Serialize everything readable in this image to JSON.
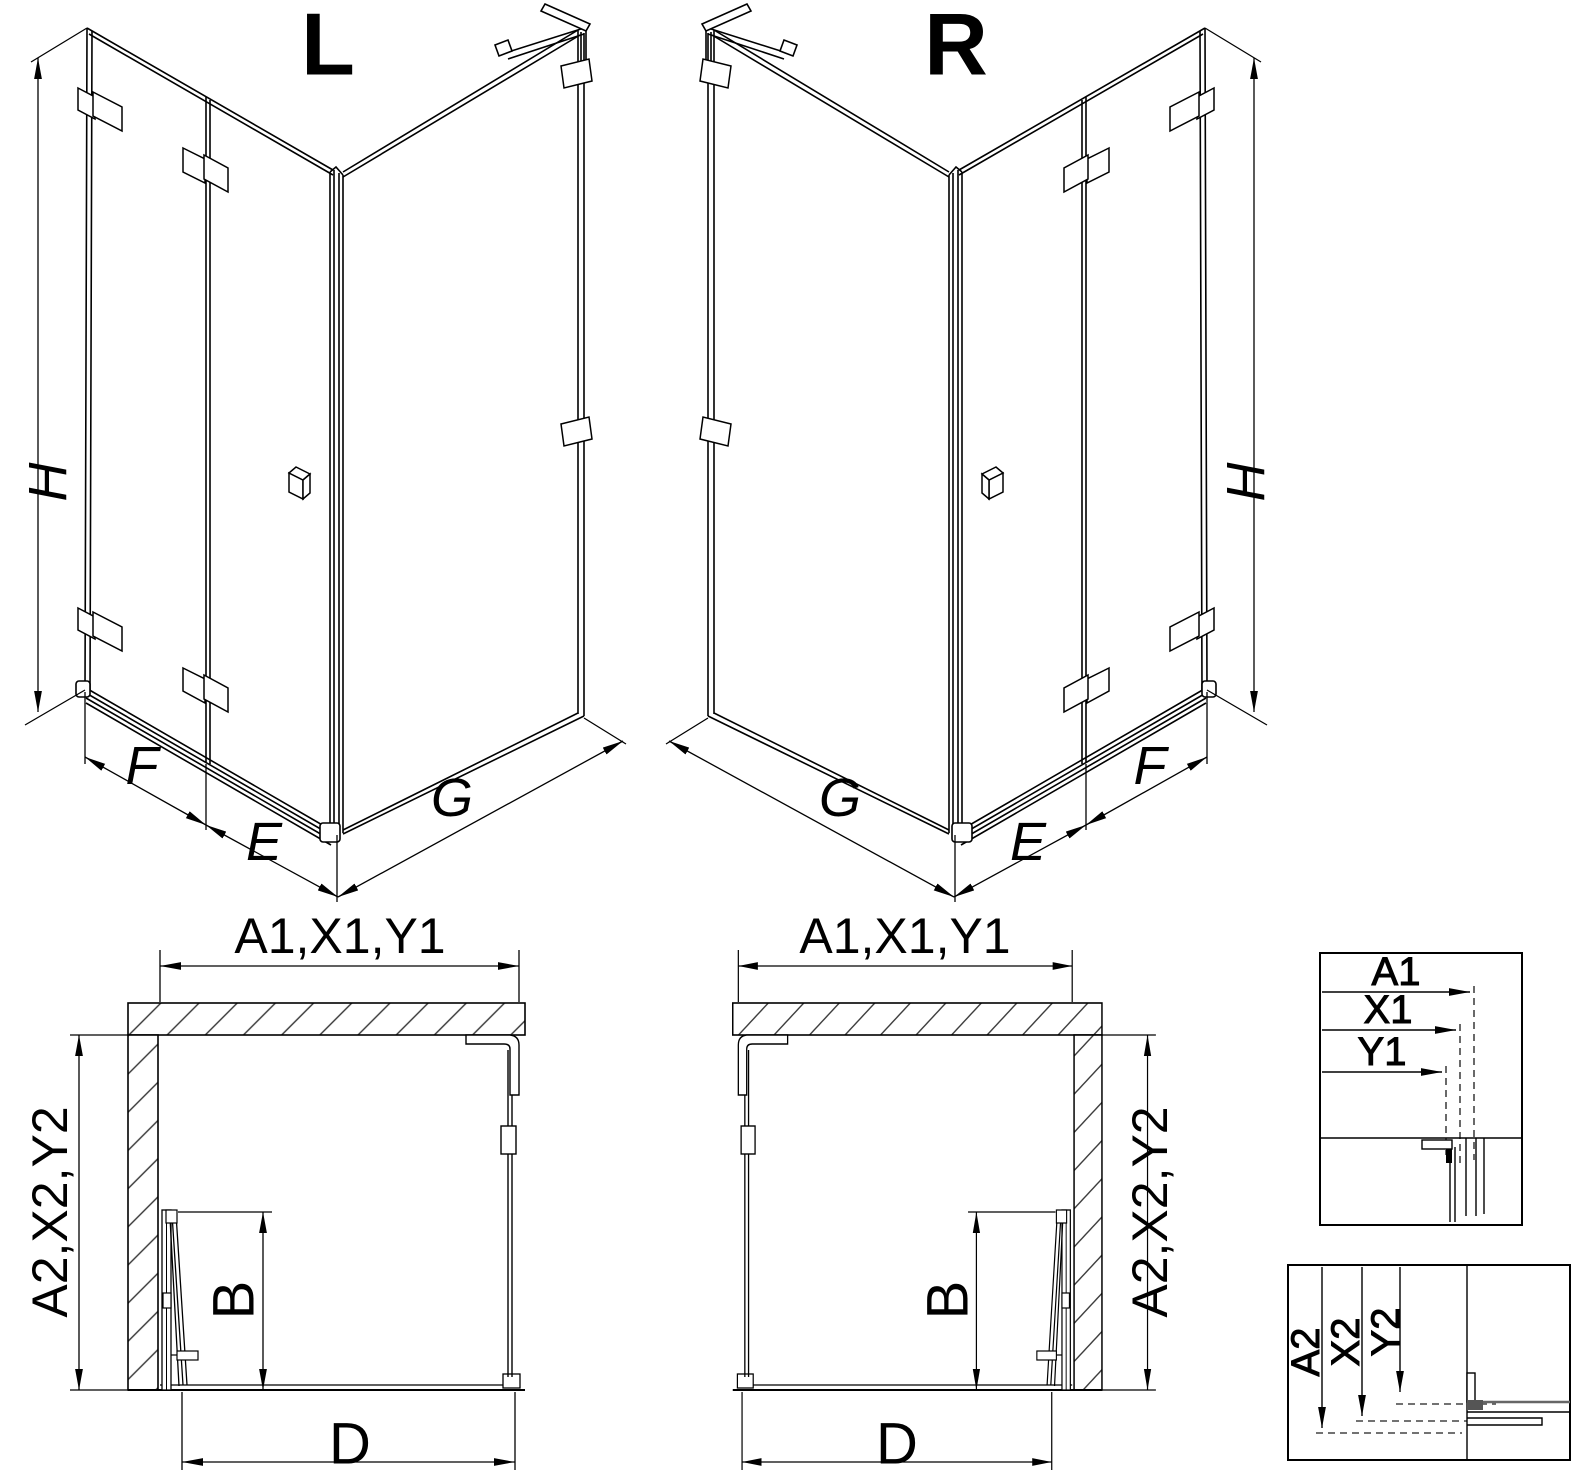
{
  "views": {
    "iso_left": {
      "title": "L",
      "height_label": "H",
      "width_labels": [
        "F",
        "E",
        "G"
      ]
    },
    "iso_right": {
      "title": "R",
      "height_label": "H",
      "width_labels": [
        "G",
        "E",
        "F"
      ]
    },
    "plan_left": {
      "width_label": "A1,X1,Y1",
      "depth_label": "A2,X2,Y2",
      "door_label": "B",
      "entry_label": "D"
    },
    "plan_right": {
      "width_label": "A1,X1,Y1",
      "depth_label": "A2,X2,Y2",
      "door_label": "B",
      "entry_label": "D"
    }
  },
  "details": {
    "width": {
      "items": [
        "A1",
        "X1",
        "Y1"
      ]
    },
    "depth": {
      "items": [
        "A2",
        "X2",
        "Y2"
      ]
    }
  },
  "style": {
    "line_color": "#000000",
    "background": "#ffffff"
  }
}
